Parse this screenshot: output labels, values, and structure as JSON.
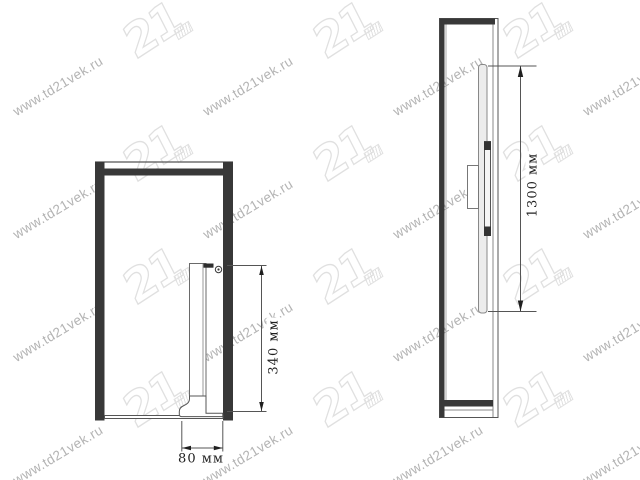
{
  "page": {
    "background": "#ffffff",
    "width": 640,
    "height": 480
  },
  "watermark": {
    "url_text": "www.td21vek.ru",
    "logo_text": "21",
    "text_color": "#b3b3b3",
    "logo_outline_color": "#e0e0e0",
    "angle_deg": -31,
    "grid": {
      "cols": 4,
      "rows": 4,
      "tile_width": 190,
      "tile_height": 123,
      "text_offset_x": 58,
      "text_offset_y": 86,
      "logo_offset_x": 152,
      "logo_offset_y": 30
    }
  },
  "drawing": {
    "line_color": "#555555",
    "dark_fill": "#383838",
    "dim_text_color": "#1f1f1f",
    "front_view": {
      "height_dim_label": "340 мм",
      "width_dim_label": "80 мм"
    },
    "side_view": {
      "length_dim_label": "1300 мм"
    }
  }
}
